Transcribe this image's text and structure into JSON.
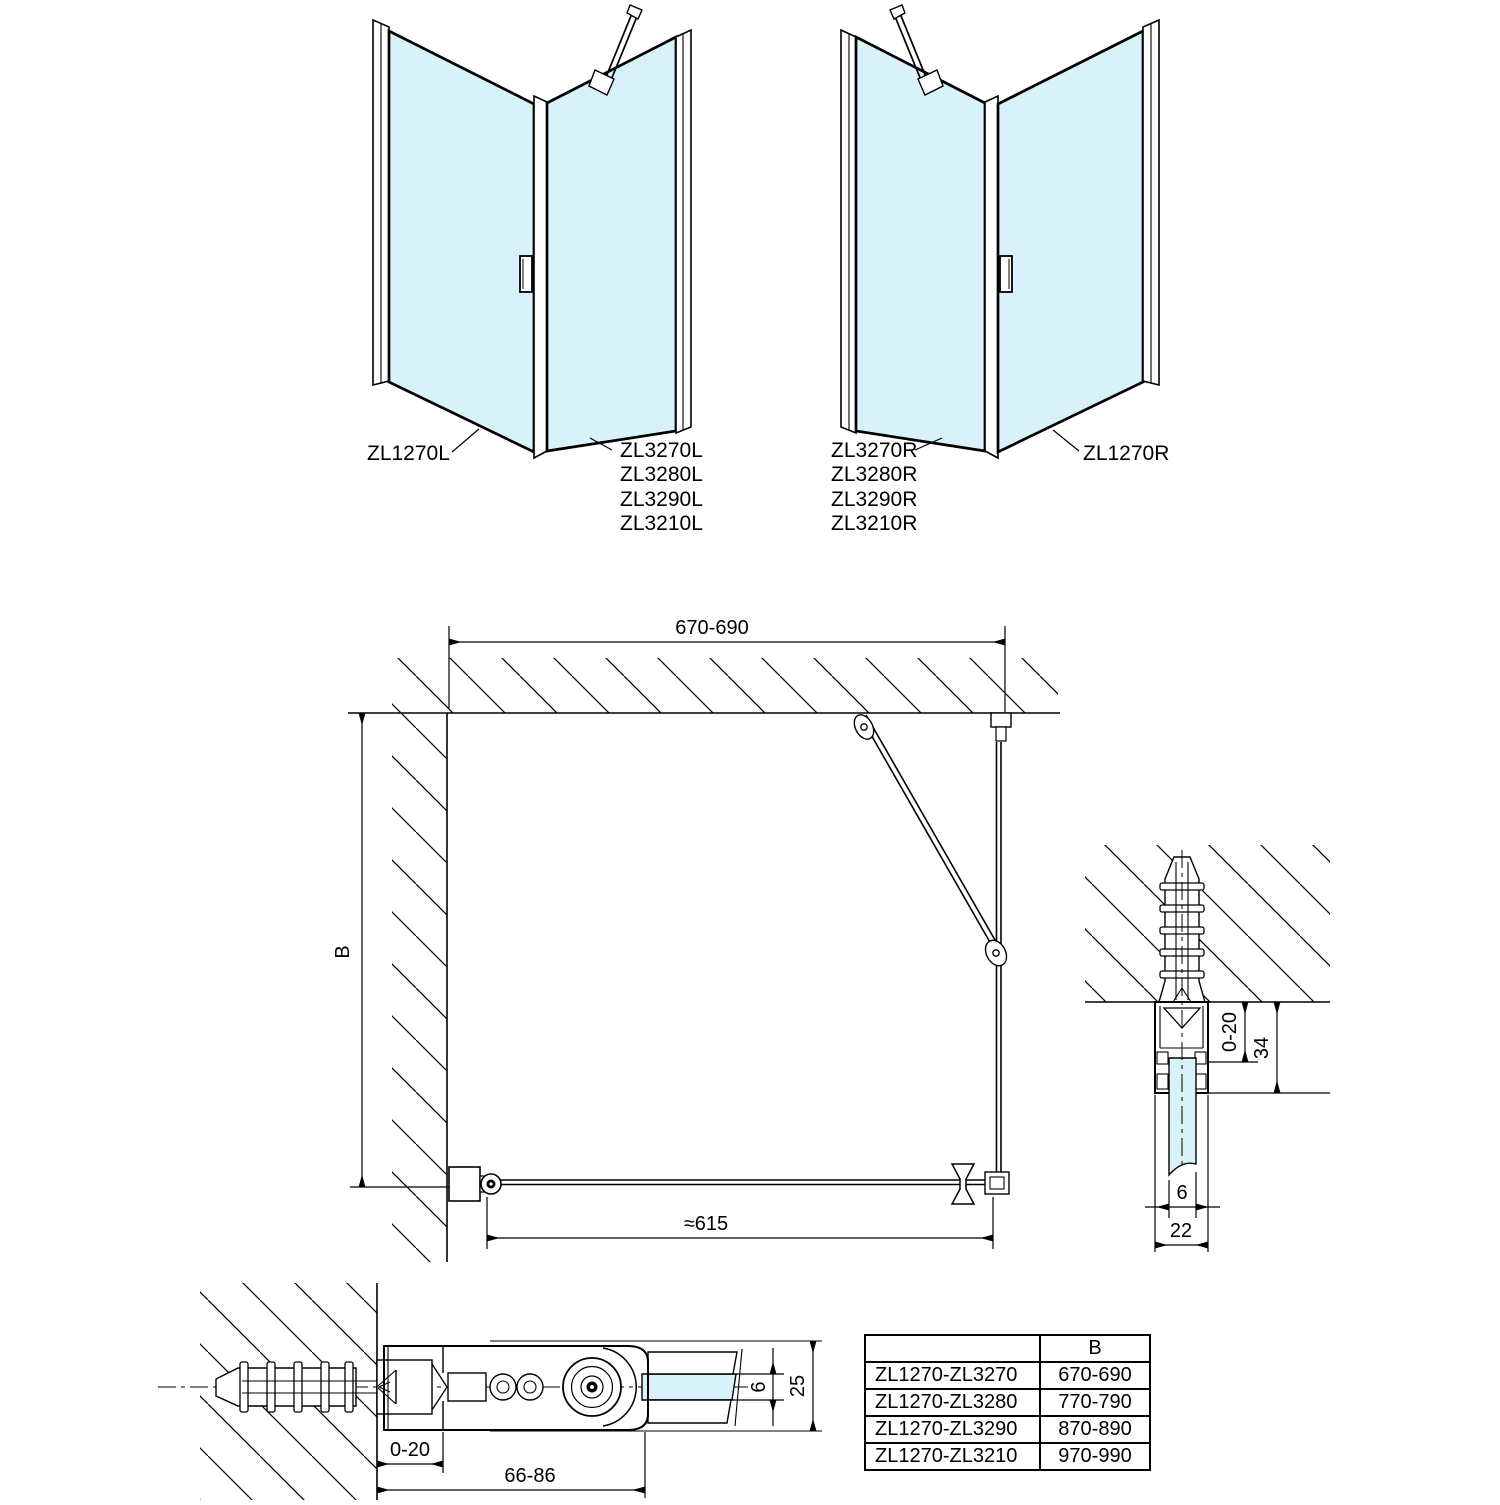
{
  "colors": {
    "glass": "#d9f2f9",
    "line": "#000000"
  },
  "iso_left": {
    "door_label": "ZL1270L",
    "panel_labels": [
      "ZL3270L",
      "ZL3280L",
      "ZL3290L",
      "ZL3210L"
    ]
  },
  "iso_right": {
    "door_label": "ZL1270R",
    "panel_labels": [
      "ZL3270R",
      "ZL3280R",
      "ZL3290R",
      "ZL3210R"
    ]
  },
  "plan": {
    "top_width": "670-690",
    "height_label": "B",
    "door_width": "≈615"
  },
  "wall_profile": {
    "adjust": "0-20",
    "depth": "34",
    "glass": "6",
    "width": "22"
  },
  "hinge": {
    "adjust": "0-20",
    "span": "66-86",
    "glass": "6",
    "height": "25"
  },
  "table": {
    "col_header": "B",
    "rows": [
      {
        "model": "ZL1270-ZL3270",
        "b": "670-690"
      },
      {
        "model": "ZL1270-ZL3280",
        "b": "770-790"
      },
      {
        "model": "ZL1270-ZL3290",
        "b": "870-890"
      },
      {
        "model": "ZL1270-ZL3210",
        "b": "970-990"
      }
    ]
  }
}
